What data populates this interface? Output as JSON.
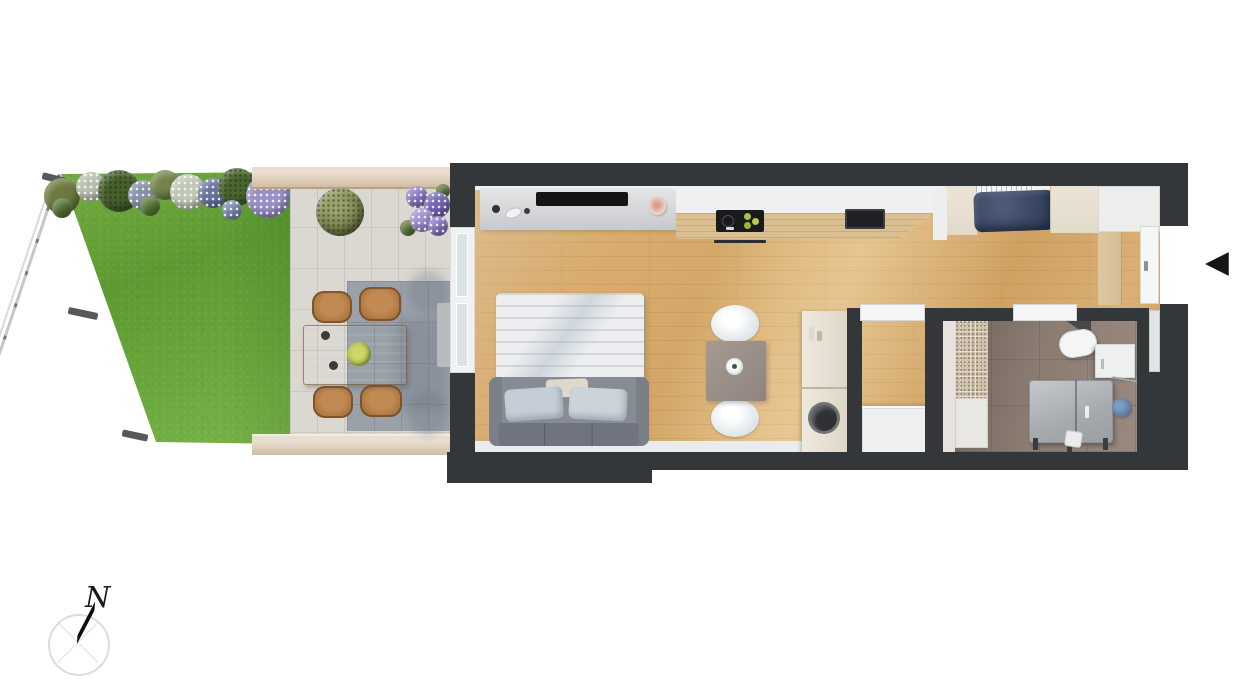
{
  "compass": {
    "label": "N"
  },
  "entrance": {
    "arrow_glyph": "◀",
    "direction": "left"
  },
  "palette": {
    "wall": "#33373a",
    "wood_floor": "#d9ad6a",
    "lawn_green": "#68a63a",
    "patio_paving": "#dbd8d2",
    "dark_pavers": "#9ba1a9",
    "planter_wood": "#dcc9b2",
    "outdoor_table_wood": "#a9743f",
    "sofa_gray": "#80848d",
    "bed_linen_white": "#eceeef",
    "nook_bed_navy": "#3a4763",
    "bathroom_floor": "#83746b",
    "shower_mosaic": "#cfc0a6",
    "towel_blue": "#5e80a6"
  },
  "garden": {
    "elements": [
      "lawn",
      "chain-link-fence",
      "flower-bed",
      "boxwood-shrub",
      "hydrangea",
      "paved-terrace",
      "dark-paver-patch",
      "planter-top",
      "planter-bottom",
      "outdoor-dining-table",
      "outdoor-chairs",
      "serving-bowl",
      "doormat"
    ],
    "outdoor_chair_count": 4
  },
  "apartment": {
    "rooms": [
      "living-room-with-kitchenette",
      "hallway-with-sleeping-nook",
      "storage-room",
      "bathroom"
    ],
    "furniture": [
      "tv-sideboard",
      "tv",
      "candle",
      "kitchen-counter",
      "cooktop",
      "oven-handle",
      "sink",
      "sofa-bed",
      "pillows",
      "dining-table",
      "dining-chairs",
      "tall-appliance-cabinet",
      "storage-cabinet",
      "shower",
      "toilet",
      "corner-shelf",
      "vanity",
      "bathtub",
      "towel",
      "wardrobes",
      "nook-bed",
      "radiator",
      "entry-cabinet",
      "entrance-door",
      "terrace-glass-door"
    ],
    "dining_chair_count": 2
  }
}
